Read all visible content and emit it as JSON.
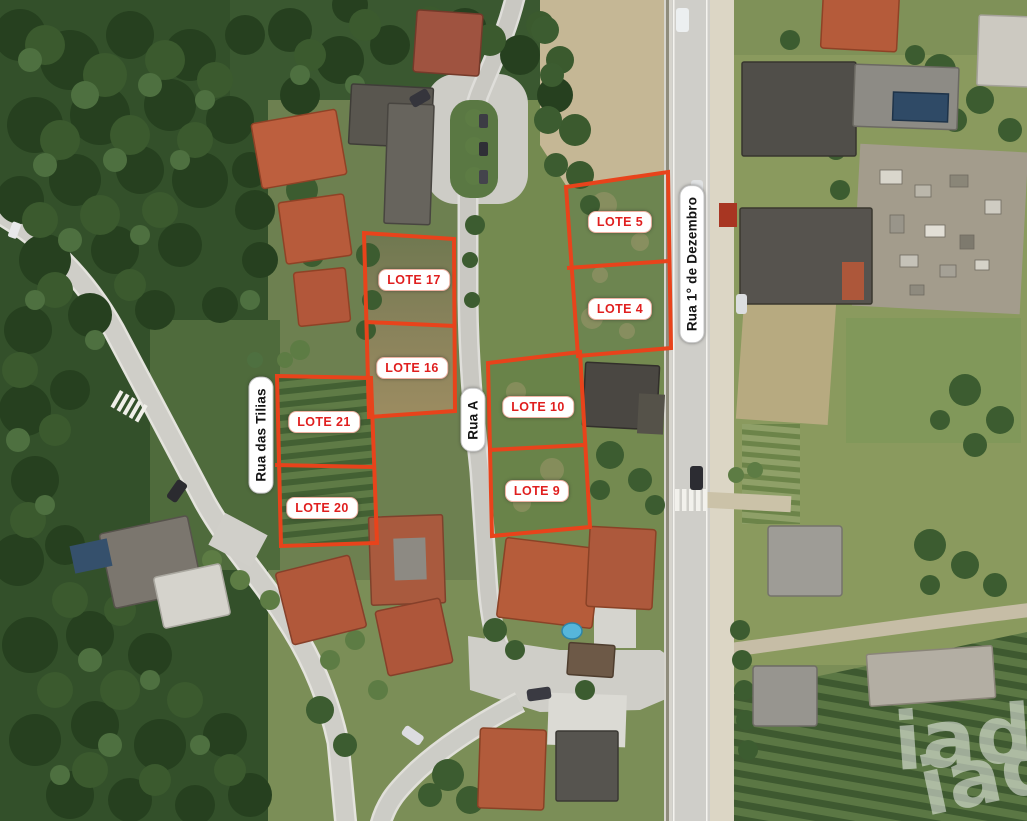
{
  "image_type": "aerial-lot-plan-photo",
  "watermark": {
    "text": "iad"
  },
  "lot_labels": [
    {
      "id": "lote-17",
      "label": "LOTE 17"
    },
    {
      "id": "lote-16",
      "label": "LOTE 16"
    },
    {
      "id": "lote-21",
      "label": "LOTE 21"
    },
    {
      "id": "lote-20",
      "label": "LOTE 20"
    },
    {
      "id": "lote-10",
      "label": "LOTE 10"
    },
    {
      "id": "lote-9",
      "label": "LOTE 9"
    },
    {
      "id": "lote-5",
      "label": "LOTE 5"
    },
    {
      "id": "lote-4",
      "label": "LOTE 4"
    }
  ],
  "street_labels": [
    {
      "id": "rua-das-tilias",
      "name": "Rua das Tilias"
    },
    {
      "id": "rua-a",
      "name": "Rua A"
    },
    {
      "id": "rua-1-de-dezembro",
      "name": "Rua 1° de Dezembro"
    }
  ],
  "colors": {
    "lot_outline": "#e8431b",
    "lot_label_text": "#e01f1f",
    "street_label_text": "#131313",
    "label_background": "#ffffff",
    "watermark_color": "#ffffff"
  }
}
